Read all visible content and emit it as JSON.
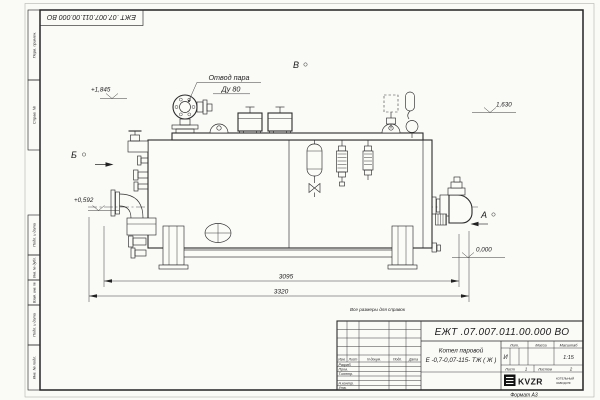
{
  "colors": {
    "paper": "#fbfbf8",
    "line": "#2b2b2b",
    "logo_bg": "#111111"
  },
  "sheet": {
    "top_stamp": "ЕЖТ .07.007.011.00.000  ВО",
    "format_note": "Формат А3",
    "reference_note": "Все размеры для справок",
    "margin_labels": {
      "perv_primen": "Перв. примен.",
      "sprav_no": "Справ. №",
      "podp_data_1": "Подп. и дата",
      "inv_dubl": "Инв. № дубл.",
      "vzam_inv": "Взам. инв. №",
      "podp_data_2": "Подп. и дата",
      "inv_podl": "Инв. № подл."
    }
  },
  "drawing": {
    "callout_line1": "Отвод пара",
    "callout_line2": "Ду 80",
    "view_a": "А",
    "view_b": "Б",
    "view_v": "В",
    "elev_top": "+1,845",
    "elev_right": "1,630",
    "elev_mid": "+0,592",
    "elev_zero": "0,000",
    "dim_inner": "3095",
    "dim_outer": "3320"
  },
  "title_block": {
    "designation": "ЕЖТ .07.007.011.00.000  ВО",
    "product_line1": "Котел паровой",
    "product_line2": "Е -0,7-0,07-115- ТЖ ( Ж )",
    "columns": {
      "izm": "Изм.",
      "list": "Лист",
      "doc": "N докум.",
      "podp": "Подп.",
      "data": "Дата"
    },
    "rows": {
      "razrab": "Разраб.",
      "prov": "Пров.",
      "tkontr": "Т.контр.",
      "nkontr": "Н.контр.",
      "utv": "Утв."
    },
    "lit_label": "Лит.",
    "mass_label": "Масса",
    "scale_label": "Масштаб",
    "lit_value": "И",
    "scale_value": "1:15",
    "sheet_label": "Лист",
    "sheet_value": "1",
    "sheets_label": "Листов",
    "sheets_value": "2",
    "logo_text": "KVZR",
    "logo_sub1": "КОТЕЛЬНЫЙ",
    "logo_sub2": "ЗАВОД.РФ"
  }
}
